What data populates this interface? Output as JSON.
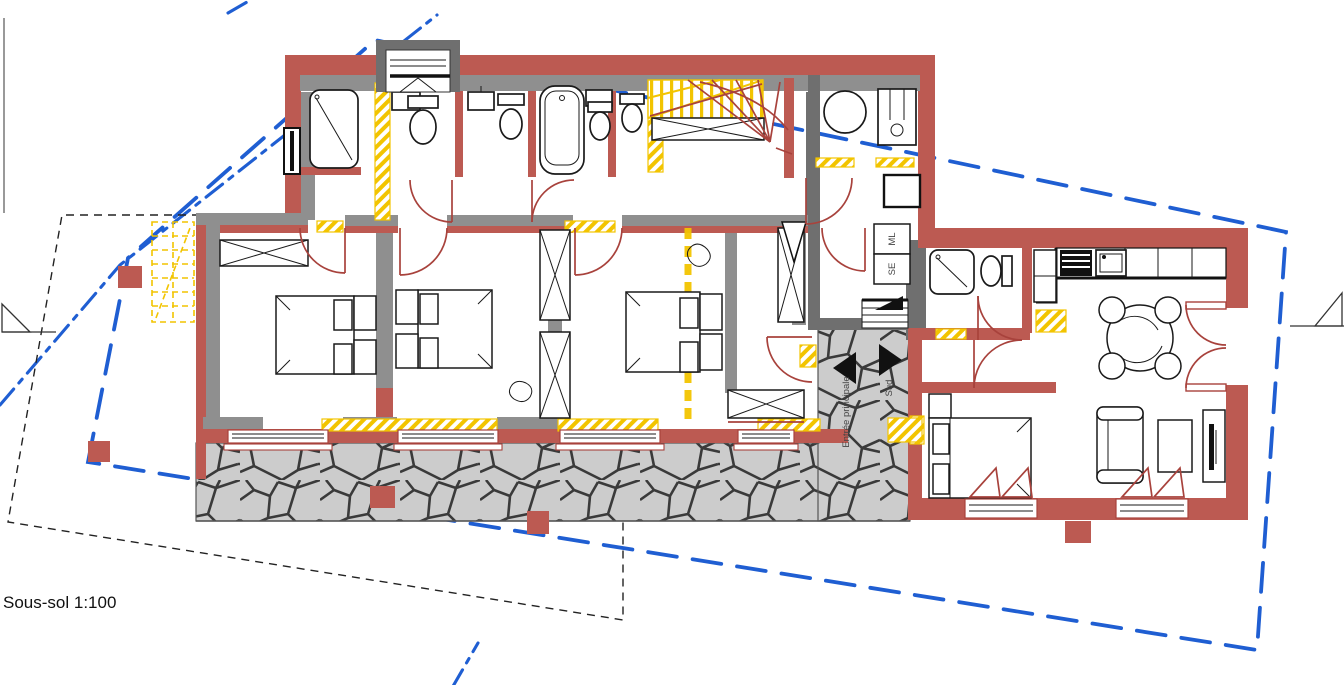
{
  "drawing": {
    "scale_label": "Sous-sol 1:100",
    "floor_name": "Sous-sol",
    "scale": "1:100"
  },
  "annotations": {
    "washing_machine_label": "ML",
    "dryer_label": "SE",
    "main_entrance_label": "Entrée principale",
    "south_label": "Sud"
  },
  "colors": {
    "background": "#ffffff",
    "new_wall_red": "#bc5a52",
    "existing_wall_gray": "#8f8f8f",
    "existing_wall_dark_gray": "#6f6f6f",
    "demolition_yellow": "#f2c400",
    "boundary_blue": "#1f5ed2",
    "door_red": "#a8423c",
    "stone_fill": "#cccccc",
    "stone_joint": "#3a3a3a",
    "line_black": "#1a1a1a"
  }
}
